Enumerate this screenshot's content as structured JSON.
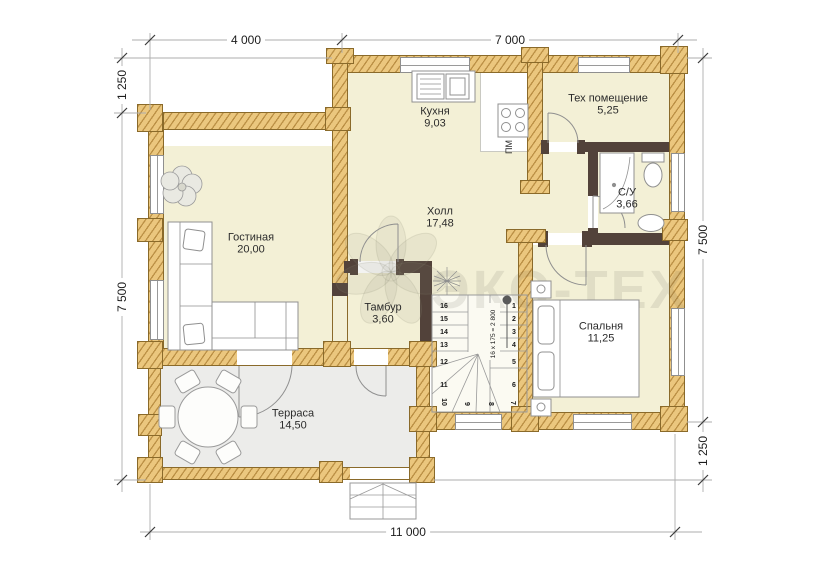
{
  "watermark": {
    "brand": "ЭКО-ТЕХ"
  },
  "rooms": {
    "kitchen": {
      "name": "Кухня",
      "area": "9,03"
    },
    "tech": {
      "name": "Тех помещение",
      "area": "5,25"
    },
    "bath": {
      "name": "С/У",
      "area": "3,66"
    },
    "hall": {
      "name": "Холл",
      "area": "17,48"
    },
    "living": {
      "name": "Гостиная",
      "area": "20,00"
    },
    "tambour": {
      "name": "Тамбур",
      "area": "3,60"
    },
    "bedroom": {
      "name": "Спальня",
      "area": "11,25"
    },
    "terrace": {
      "name": "Терраса",
      "area": "14,50"
    }
  },
  "appliances": {
    "dishwasher": "ПМ"
  },
  "stairs": {
    "formula": "16 х 175 = 2 800",
    "numbers": {
      "right": [
        "1",
        "2",
        "3",
        "4",
        "5",
        "6"
      ],
      "bottom": [
        "7",
        "8",
        "9",
        "10"
      ],
      "left": [
        "11",
        "12",
        "13",
        "14",
        "15",
        "16"
      ]
    }
  },
  "dimensions": {
    "top": [
      "4 000",
      "7 000"
    ],
    "bottom": [
      "11 000"
    ],
    "left": [
      "1 250",
      "7 500"
    ],
    "right": [
      "7 500",
      "1 250"
    ]
  },
  "colors": {
    "wall": "#ebc77e",
    "wall_hatch": "#94621 6",
    "dark_wall": "#52423a",
    "floor": "#f3f0d6",
    "terrace_floor": "#ececea",
    "outline": "#8a6a2a"
  }
}
